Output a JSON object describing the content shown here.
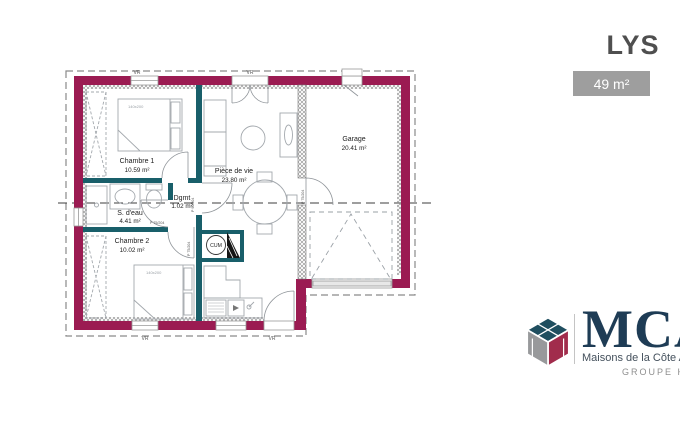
{
  "header": {
    "title": "LYS",
    "area_badge": "49 m²"
  },
  "plan": {
    "rooms": [
      {
        "name": "Chambre 1",
        "area": "10.59 m²"
      },
      {
        "name": "S. d'eau",
        "area": "4.41 m²"
      },
      {
        "name": "Chambre 2",
        "area": "10.02 m²"
      },
      {
        "name": "Dgmt",
        "area": "1.02 m²"
      },
      {
        "name": "Pièce de vie",
        "area": "23.80 m²"
      },
      {
        "name": "Garage",
        "area": "20.41 m²"
      }
    ],
    "annotations": {
      "water_heater": "CUM",
      "roller_shutter": "VR",
      "door_75": "P 75/204",
      "door_90": "P 90/204",
      "bed_size": "140x200"
    },
    "colors": {
      "exterior_wall": "#9b1b52",
      "interior_wall": "#195f6a",
      "furniture": "#a3a8ad",
      "label_text": "#1c1c1c"
    }
  },
  "logo": {
    "name": "MCA",
    "subtitle": "Maisons de la Côte Atlantique",
    "group": "GROUPE Hexaōm",
    "colors": {
      "navy": "#1e3c55",
      "gray": "#98999b",
      "crimson": "#a12c4c",
      "teal": "#1f4e5f"
    }
  }
}
